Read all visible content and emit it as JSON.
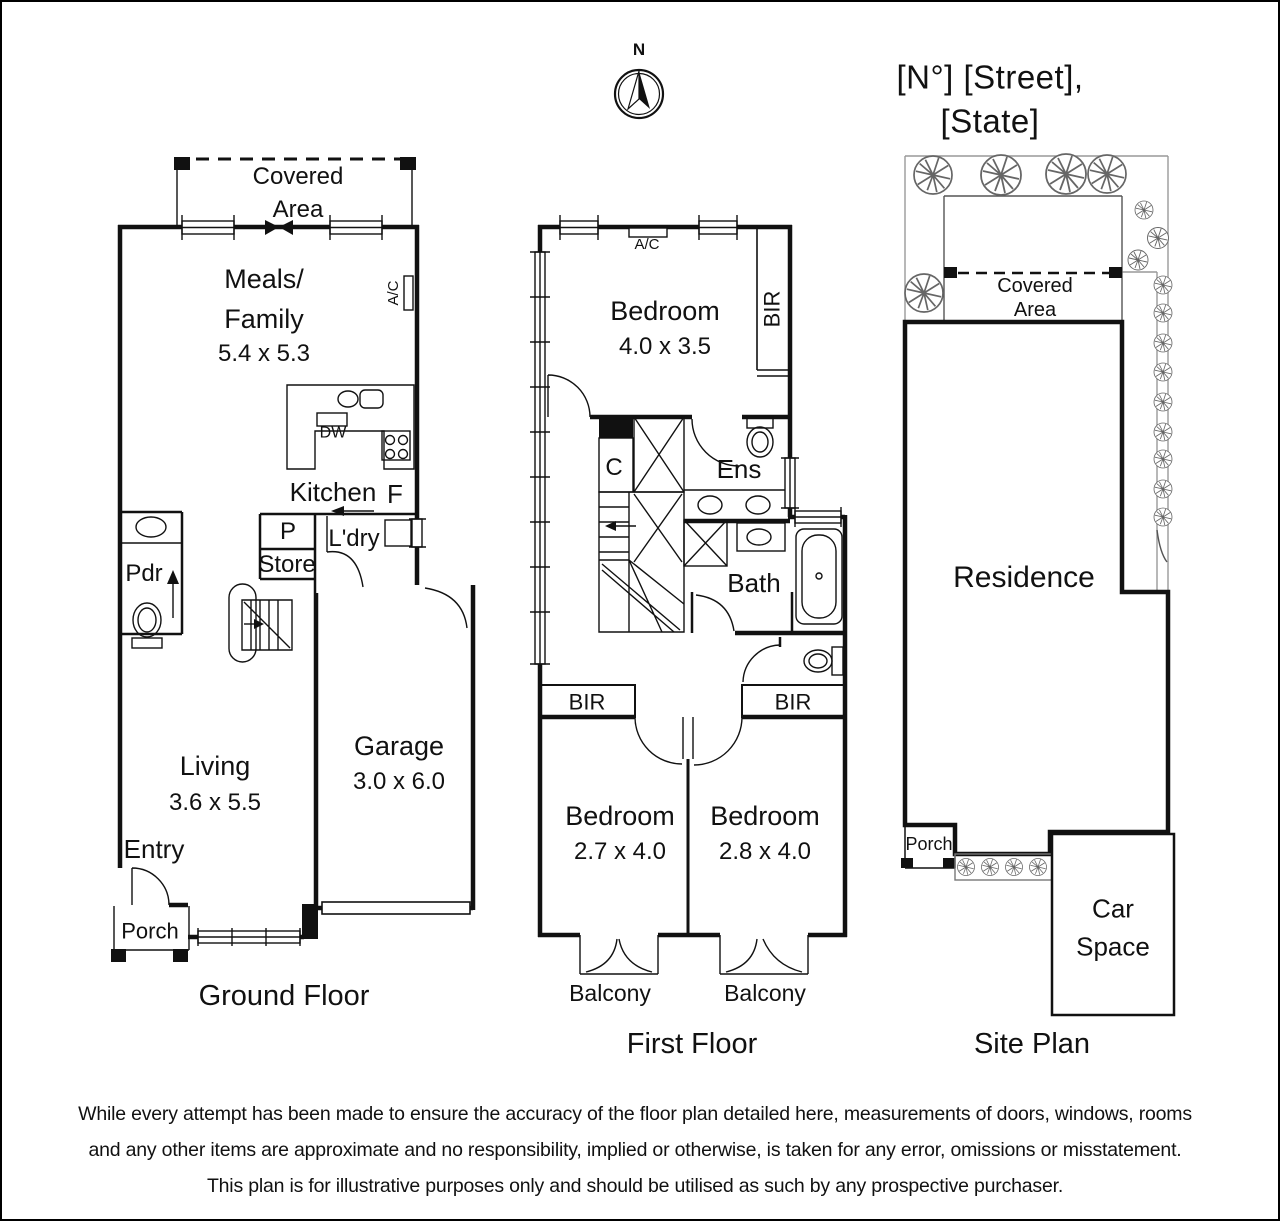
{
  "header": {
    "compass_n": "N",
    "title": "[N°] [Street], [State]"
  },
  "ground_floor": {
    "caption": "Ground Floor",
    "covered_area": "Covered\nArea",
    "meals": "Meals/\nFamily",
    "meals_dim": "5.4 x 5.3",
    "ac": "A/C",
    "dw": "DW",
    "kitchen": "Kitchen",
    "fridge": "F",
    "pantry": "P",
    "store": "Store",
    "laundry": "L'dry",
    "powder": "Pdr",
    "living": "Living",
    "living_dim": "3.6 x 5.5",
    "garage": "Garage",
    "garage_dim": "3.0 x 6.0",
    "entry": "Entry",
    "porch": "Porch"
  },
  "first_floor": {
    "caption": "First Floor",
    "ac": "A/C",
    "bedroom1": "Bedroom",
    "bedroom1_dim": "4.0 x 3.5",
    "bir_right": "BIR",
    "closet": "C",
    "ensuite": "Ens",
    "bath": "Bath",
    "bir_left": "BIR",
    "bir_mid": "BIR",
    "bedroom2": "Bedroom",
    "bedroom2_dim": "2.7 x 4.0",
    "bedroom3": "Bedroom",
    "bedroom3_dim": "2.8 x 4.0",
    "balcony_left": "Balcony",
    "balcony_right": "Balcony"
  },
  "site_plan": {
    "caption": "Site Plan",
    "covered_area": "Covered\nArea",
    "residence": "Residence",
    "porch": "Porch",
    "car_space": "Car\nSpace"
  },
  "disclaimer": {
    "line1": "While every attempt has been made to ensure the accuracy of the floor plan detailed here, measurements of doors, windows, rooms",
    "line2": "and any other items are approximate and no responsibility, implied or otherwise, is taken for any error, omissions or misstatement.",
    "line3": "This plan is for illustrative purposes only and should be utilised as such by any prospective purchaser."
  }
}
